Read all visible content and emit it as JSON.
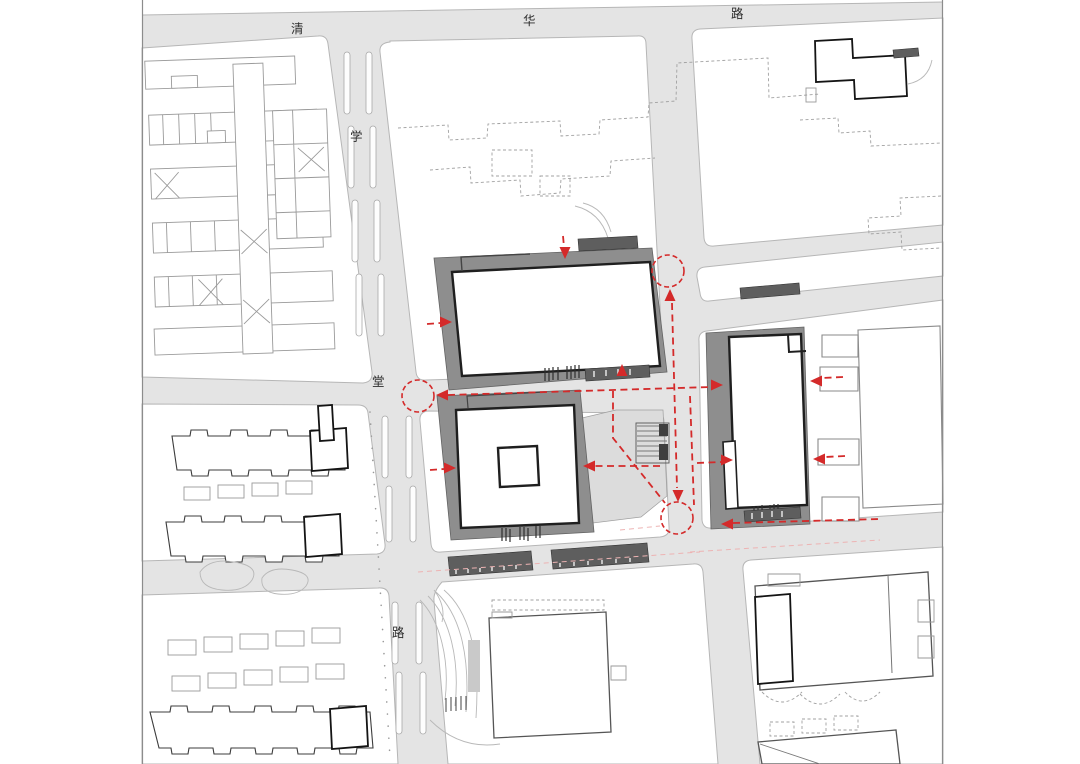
{
  "streets": {
    "top": {
      "name": "清华路",
      "characters": [
        "清",
        "华",
        "路"
      ]
    },
    "left": {
      "name": "学堂路",
      "characters": [
        "学",
        "堂",
        "路"
      ]
    }
  },
  "colors": {
    "road_fill": "#e4e4e4",
    "parcel_fill": "#ffffff",
    "podium_gray": "#8e8e8e",
    "plaza_gray": "#dcdcdc",
    "dark_bar": "#5e5e5e",
    "building_outline": "#1f1f1f",
    "linework_gray": "#9a9a9a",
    "circulation_red": "#d42a2a"
  },
  "circulation": {
    "color": "#d42a2a",
    "nodes": [
      {
        "cx": 418,
        "cy": 396,
        "r": 16
      },
      {
        "cx": 668,
        "cy": 271,
        "r": 16
      },
      {
        "cx": 677,
        "cy": 518,
        "r": 16
      }
    ],
    "routes": [
      {
        "d": "M448,395 L711,387"
      },
      {
        "d": "M672,303 L677,488"
      },
      {
        "d": "M733,523 L880,519"
      },
      {
        "d": "M613,391 L613,438 L665,503"
      },
      {
        "d": "M660,466 L595,466"
      },
      {
        "d": "M690,396 L694,505"
      },
      {
        "d": "M427,324 L440,323"
      },
      {
        "d": "M430,470 L444,469"
      },
      {
        "d": "M563,236 L564,247"
      },
      {
        "d": "M843,377 L822,378"
      },
      {
        "d": "M845,456 L825,457"
      },
      {
        "d": "M697,463 L721,462"
      }
    ],
    "arrows": [
      {
        "x": 436,
        "y": 395,
        "dir": "left"
      },
      {
        "x": 723,
        "y": 385,
        "dir": "right"
      },
      {
        "x": 670,
        "y": 289,
        "dir": "up"
      },
      {
        "x": 678,
        "y": 502,
        "dir": "down"
      },
      {
        "x": 721,
        "y": 524,
        "dir": "left"
      },
      {
        "x": 565,
        "y": 259,
        "dir": "down"
      },
      {
        "x": 452,
        "y": 322,
        "dir": "right"
      },
      {
        "x": 622,
        "y": 364,
        "dir": "up"
      },
      {
        "x": 456,
        "y": 468,
        "dir": "right"
      },
      {
        "x": 583,
        "y": 466,
        "dir": "left"
      },
      {
        "x": 733,
        "y": 460,
        "dir": "right"
      },
      {
        "x": 810,
        "y": 381,
        "dir": "left"
      },
      {
        "x": 813,
        "y": 459,
        "dir": "left"
      }
    ]
  }
}
